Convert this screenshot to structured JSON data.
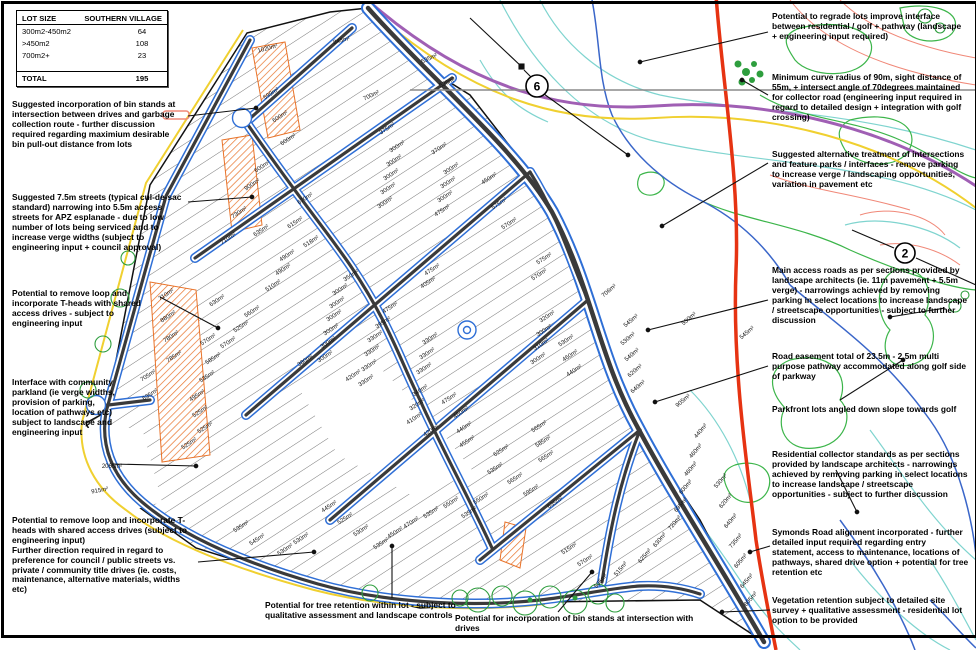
{
  "table": {
    "title": "LOT SIZE",
    "column": "SOUTHERN VILLAGE",
    "rows": [
      {
        "label": "300m2-450m2",
        "value": "64"
      },
      {
        "label": ">450m2",
        "value": "108"
      },
      {
        "label": "700m2+",
        "value": "23"
      }
    ],
    "total_label": "TOTAL",
    "total_value": "195"
  },
  "annotations": {
    "bin_stands": "Suggested incorporation of bin stands at intersection between drives and garbage collection route - further discussion required regarding maximium desirable bin pull-out distance from lots",
    "streets_7_5m": "Suggested 7.5m streets (typical cul-de-sac standard) narrowing into 5.5m access streets for APZ esplanade - due to low number of lots being serviced and to increase verge widths (subject to engineering input + council approval)",
    "remove_loop_t_heads": "Potential to remove loop and incorporate T-heads with shared access drives - subject to engineering input",
    "community_parkland": "Interface with community parkland (ie verge widths, provision of parking, location of pathways etc) subject to landscape and engineering input",
    "remove_loop_bottom": "Potential to remove loop and incorporate T-heads with shared access drives (subject to engineering input)\nFurther direction required in regard to preference for council / public streets vs. private / community title drives (ie. costs, maintenance, alternative materials, widths etc)",
    "tree_retention": "Potential for tree retention within lot - subject to qualitative assessment and landscape controls",
    "bin_stands_bottom": "Potential for incorporation of bin stands at intersection with drives",
    "regrade_lots": "Potential to regrade lots improve interface between residential / golf + pathway (landscape + engineering input required)",
    "curve_radius": "Minimum curve radius of 90m, sight distance of 55m, + intersect angle of 70degrees maintained for collector road (engineering input required in regard to detailed design + integration with golf crossing)",
    "intersection_treatment": "Suggested alternative treatment of intersections and feature parks / interfaces - remove parking to increase verge / landscaping opportunities, variation in pavement etc",
    "main_access_roads": "Main access roads as per sections provided by landscape architects (ie. 11m pavement + 5.5m verge) - narrowings achieved by removing parking in select locations to increase landscape / streetscape opportunities - subject to further discussion",
    "road_easement": "Road easement total of 23.5m - 2.5m multi purpose pathway accommodated along golf side of parkway",
    "parkfront_lots": "Parkfront lots angled down slope towards golf",
    "residential_collector": "Residential collector standards as per sections provided by landscape architects - narrowings achieved by removing parking in select locations to increase landscape / streetscape opportunities - subject to further discussion",
    "symonds_road": "Symonds Road alignment incorporated - further detailed input required regarding entry statement, access to maintenance, locations of pathways, shared drive option + potential for tree retention etc",
    "vegetation_retention": "Vegetation retention subject to detailed site survey + qualitative assessment - residential lot option to be provided"
  },
  "plan": {
    "markers": [
      {
        "n": "6"
      },
      {
        "n": "2"
      }
    ],
    "lot_labels": [
      [
        268,
        50,
        "1020m²",
        -15
      ],
      [
        342,
        42,
        "845m²",
        -15
      ],
      [
        272,
        95,
        "599m²"
      ],
      [
        281,
        118,
        "600m²"
      ],
      [
        289,
        141,
        "600m²"
      ],
      [
        263,
        168,
        "600m²"
      ],
      [
        253,
        186,
        "900m²"
      ],
      [
        240,
        214,
        "730m²"
      ],
      [
        229,
        240,
        "710m²"
      ],
      [
        306,
        200,
        "670m²"
      ],
      [
        296,
        224,
        "615m²"
      ],
      [
        312,
        243,
        "518m²"
      ],
      [
        288,
        257,
        "490m²"
      ],
      [
        284,
        271,
        "490m²"
      ],
      [
        274,
        287,
        "510m²"
      ],
      [
        262,
        232,
        "635m²"
      ],
      [
        253,
        313,
        "560m²"
      ],
      [
        242,
        328,
        "525m²"
      ],
      [
        229,
        344,
        "570m²"
      ],
      [
        167,
        296,
        "710m²"
      ],
      [
        169,
        318,
        "880m²"
      ],
      [
        172,
        338,
        "780m²"
      ],
      [
        175,
        358,
        "785m²"
      ],
      [
        149,
        377,
        "705m²"
      ],
      [
        151,
        396,
        "635m²"
      ],
      [
        218,
        302,
        "630m²"
      ],
      [
        209,
        341,
        "570m²"
      ],
      [
        214,
        360,
        "585m²"
      ],
      [
        208,
        378,
        "535m²"
      ],
      [
        198,
        397,
        "495m²"
      ],
      [
        201,
        413,
        "525m²"
      ],
      [
        206,
        429,
        "525m²"
      ],
      [
        190,
        445,
        "525m²"
      ],
      [
        112,
        468,
        "2065m²",
        0
      ],
      [
        100,
        492,
        "915m²",
        -10
      ],
      [
        372,
        97,
        "700m²",
        -25
      ],
      [
        430,
        60,
        "535m²",
        -25
      ],
      [
        448,
        84,
        "525m²",
        -25
      ],
      [
        388,
        130,
        "375m²"
      ],
      [
        398,
        148,
        "300m²"
      ],
      [
        395,
        162,
        "300m²"
      ],
      [
        392,
        176,
        "300m²"
      ],
      [
        389,
        190,
        "300m²"
      ],
      [
        386,
        204,
        "300m²"
      ],
      [
        440,
        150,
        "370m²"
      ],
      [
        452,
        170,
        "300m²"
      ],
      [
        449,
        184,
        "300m²"
      ],
      [
        446,
        198,
        "300m²"
      ],
      [
        443,
        212,
        "475m²"
      ],
      [
        490,
        180,
        "450m²"
      ],
      [
        500,
        205,
        "575m²"
      ],
      [
        510,
        225,
        "570m²"
      ],
      [
        352,
        277,
        "350m²"
      ],
      [
        341,
        291,
        "300m²"
      ],
      [
        338,
        304,
        "300m²"
      ],
      [
        335,
        317,
        "300m²"
      ],
      [
        332,
        331,
        "300m²"
      ],
      [
        329,
        344,
        "300m²"
      ],
      [
        326,
        358,
        "300m²"
      ],
      [
        306,
        362,
        "380m²"
      ],
      [
        354,
        377,
        "420m²"
      ],
      [
        376,
        338,
        "330m²"
      ],
      [
        373,
        352,
        "330m²"
      ],
      [
        370,
        367,
        "330m²"
      ],
      [
        367,
        382,
        "330m²"
      ],
      [
        384,
        324,
        "395m²"
      ],
      [
        391,
        309,
        "475m²"
      ],
      [
        433,
        271,
        "475m²"
      ],
      [
        429,
        284,
        "405m²"
      ],
      [
        431,
        340,
        "330m²"
      ],
      [
        428,
        355,
        "330m²"
      ],
      [
        425,
        370,
        "330m²"
      ],
      [
        545,
        260,
        "575m²"
      ],
      [
        540,
        276,
        "570m²"
      ],
      [
        548,
        318,
        "320m²"
      ],
      [
        545,
        332,
        "300m²"
      ],
      [
        542,
        346,
        "310m²"
      ],
      [
        539,
        360,
        "300m²"
      ],
      [
        567,
        342,
        "530m²"
      ],
      [
        571,
        357,
        "460m²"
      ],
      [
        575,
        372,
        "440m²"
      ],
      [
        610,
        292,
        "706m²",
        -40
      ],
      [
        632,
        322,
        "545m²",
        -40
      ],
      [
        629,
        340,
        "530m²",
        -40
      ],
      [
        633,
        356,
        "540m²",
        -40
      ],
      [
        636,
        372,
        "620m²",
        -40
      ],
      [
        639,
        388,
        "640m²",
        -40
      ],
      [
        690,
        320,
        "530m²",
        -40
      ],
      [
        748,
        334,
        "545m²",
        -40
      ],
      [
        684,
        402,
        "905m²",
        -40
      ],
      [
        421,
        392,
        "340m²"
      ],
      [
        418,
        406,
        "320m²"
      ],
      [
        415,
        420,
        "410m²"
      ],
      [
        432,
        432,
        "420m²"
      ],
      [
        450,
        400,
        "475m²"
      ],
      [
        462,
        414,
        "460m²"
      ],
      [
        465,
        429,
        "440m²"
      ],
      [
        468,
        443,
        "455m²"
      ],
      [
        540,
        428,
        "565m²"
      ],
      [
        544,
        443,
        "585m²"
      ],
      [
        547,
        458,
        "565m²"
      ],
      [
        502,
        452,
        "625m²"
      ],
      [
        496,
        470,
        "535m²"
      ],
      [
        516,
        480,
        "565m²"
      ],
      [
        532,
        492,
        "595m²"
      ],
      [
        556,
        504,
        "635m²"
      ],
      [
        482,
        500,
        "550m²"
      ],
      [
        470,
        514,
        "535m²"
      ],
      [
        452,
        504,
        "550m²"
      ],
      [
        432,
        514,
        "535m²"
      ],
      [
        412,
        524,
        "470m²"
      ],
      [
        396,
        534,
        "450m²"
      ],
      [
        382,
        545,
        "535m²"
      ],
      [
        362,
        532,
        "530m²"
      ],
      [
        346,
        520,
        "525m²"
      ],
      [
        330,
        508,
        "445m²"
      ],
      [
        302,
        540,
        "530m²"
      ],
      [
        286,
        551,
        "530m²"
      ],
      [
        242,
        528,
        "535m²"
      ],
      [
        258,
        541,
        "545m²"
      ],
      [
        570,
        550,
        "515m²"
      ],
      [
        586,
        562,
        "570m²"
      ],
      [
        702,
        432,
        "440m²",
        -50
      ],
      [
        697,
        452,
        "460m²",
        -50
      ],
      [
        692,
        470,
        "460m²",
        -50
      ],
      [
        687,
        488,
        "600m²",
        -50
      ],
      [
        682,
        506,
        "695m²",
        -50
      ],
      [
        676,
        524,
        "720m²",
        -50
      ],
      [
        661,
        541,
        "630m²",
        -50
      ],
      [
        646,
        557,
        "625m²",
        -50
      ],
      [
        622,
        570,
        "515m²",
        -50
      ],
      [
        602,
        582,
        "505m²",
        -50
      ],
      [
        722,
        482,
        "530m²",
        -50
      ],
      [
        727,
        502,
        "620m²",
        -50
      ],
      [
        732,
        522,
        "640m²",
        -50
      ],
      [
        737,
        542,
        "735m²",
        -50
      ],
      [
        742,
        562,
        "605m²",
        -50
      ],
      [
        748,
        582,
        "645m²",
        -50
      ],
      [
        752,
        600,
        "805m²",
        -50
      ]
    ]
  },
  "colors": {
    "road-dark": "#3a3a3a",
    "kerb-blue": "#2f6fd6",
    "boundary-yellow": "#f0d030",
    "hatch-orange": "#e8732a",
    "symonds-red": "#e63312",
    "purple-line": "#a05fb4",
    "contour-green": "#3cb54a",
    "contour-cyan": "#7fd4cf",
    "contour-salmon": "#f08878",
    "stream-blue": "#3a66c9",
    "tree-green": "#2e9e3e",
    "section-gray": "#8a8a8a"
  }
}
